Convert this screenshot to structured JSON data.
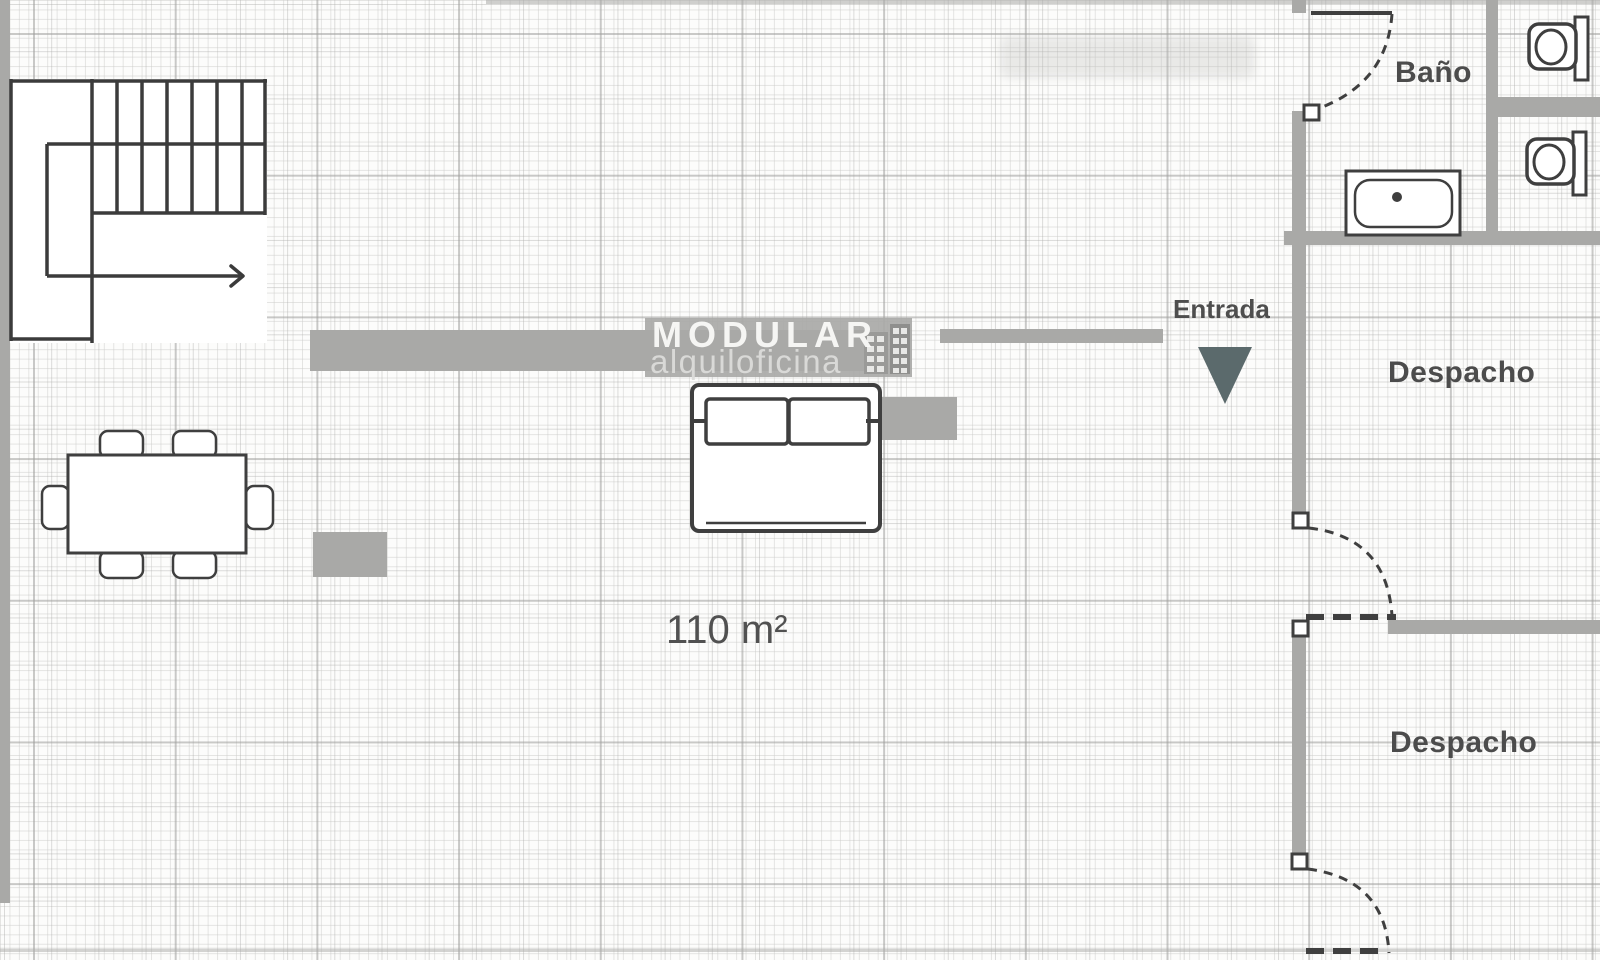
{
  "plan": {
    "rooms": {
      "bathroom_label": "Baño",
      "office1_label": "Despacho",
      "office2_label": "Despacho"
    },
    "entrance_label": "Entrada",
    "area_label": "110 m²",
    "watermark": {
      "title": "MODULAR",
      "subtitle": "alquiloficina"
    }
  },
  "colors": {
    "wall": "#a9a9a7",
    "line": "#3f3f3f",
    "stair_line": "#3b3b3b",
    "entry_arrow": "#5b6a6c",
    "furniture_fill": "#ffffff",
    "watermark_band": "#a9a9a7"
  }
}
